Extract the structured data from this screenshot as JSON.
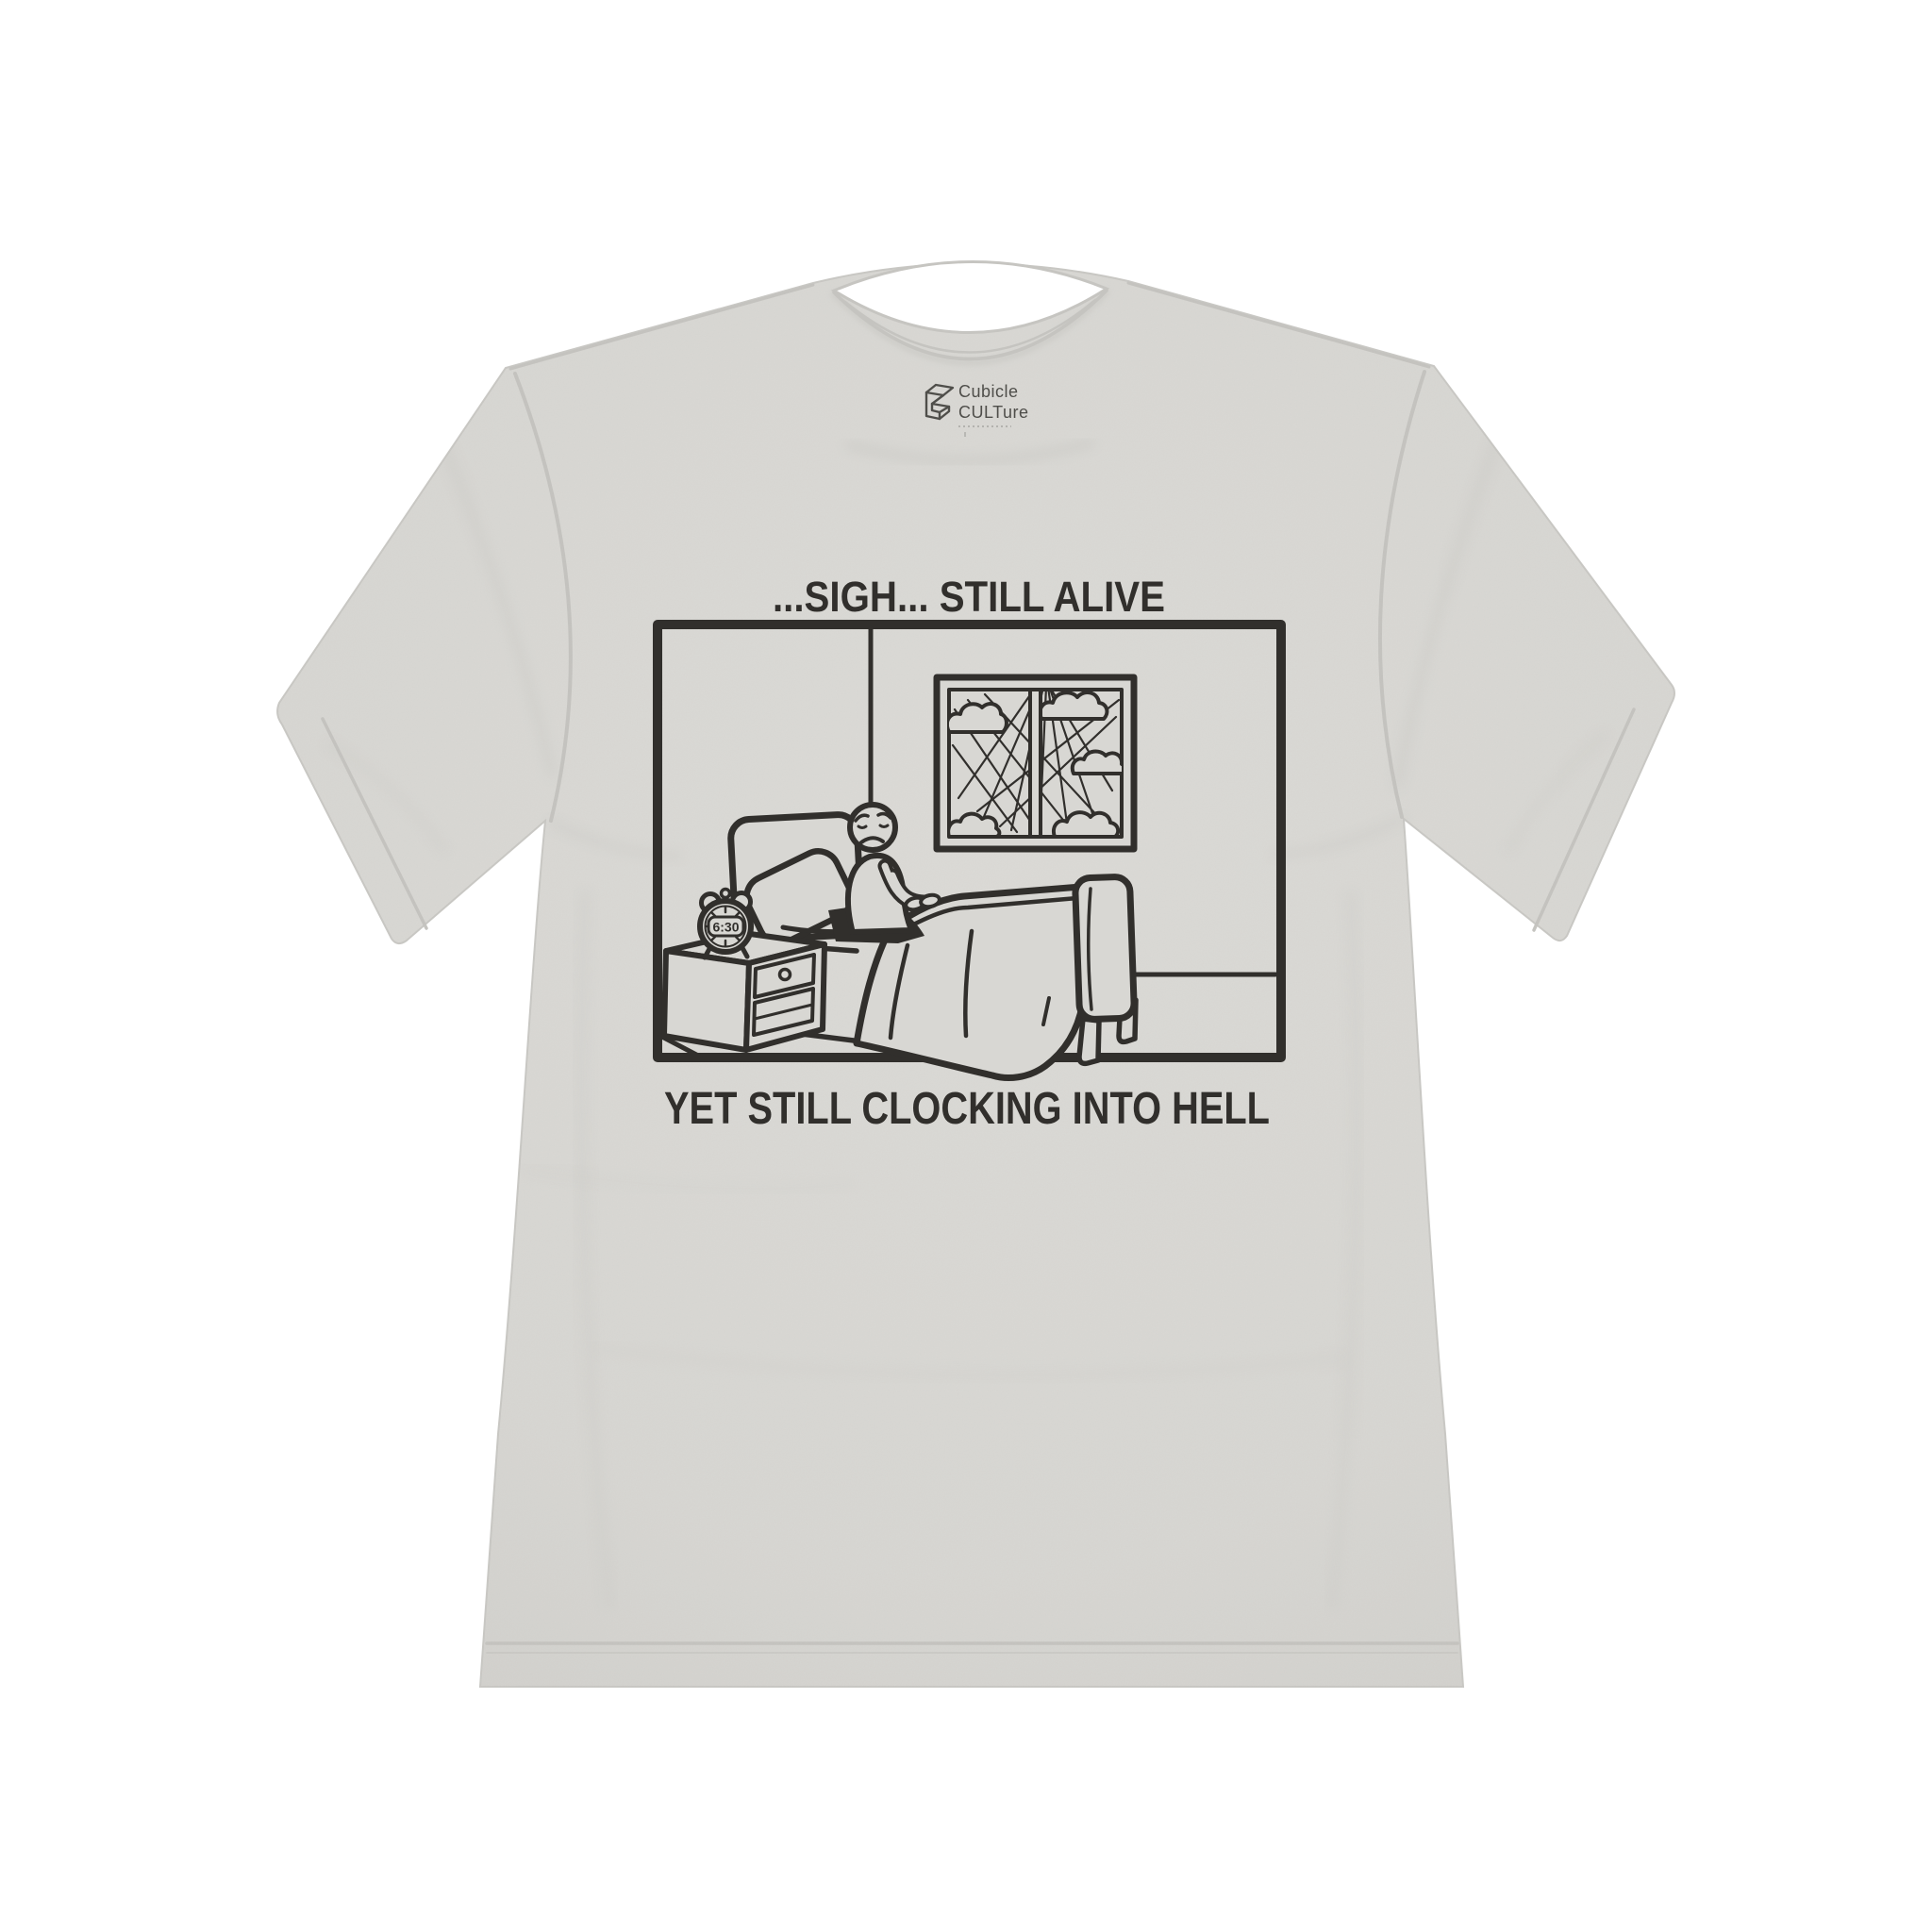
{
  "scene": {
    "kind": "t-shirt product photo, flat lay on white",
    "background_color": "#ffffff"
  },
  "shirt": {
    "color_name": "silver",
    "base_color": "#d8d7d3",
    "seam_color": "#c5c4c0",
    "style": "crew-neck short-sleeve tee"
  },
  "brand_label": {
    "logo_icon": "cubicle-open-cube-logo-icon",
    "line1": "Cubicle",
    "line2": "CULTure",
    "text_color": "#4f4e4a"
  },
  "print": {
    "ink_color": "#312f2c",
    "top_caption": "...SIGH... STILL ALIVE",
    "bottom_caption": "YET STILL CLOCKING INTO HELL",
    "clock_time": "6:30",
    "scene_elements": [
      "comic-panel-border",
      "wall-corner-line",
      "window-with-sun-rays-and-clouds",
      "sad-stick-figure-sitting-in-bed",
      "pillow",
      "headboard",
      "blanket",
      "footboard-with-legs",
      "baseboard-line",
      "nightstand-with-drawer-and-shelf",
      "alarm-clock"
    ]
  }
}
